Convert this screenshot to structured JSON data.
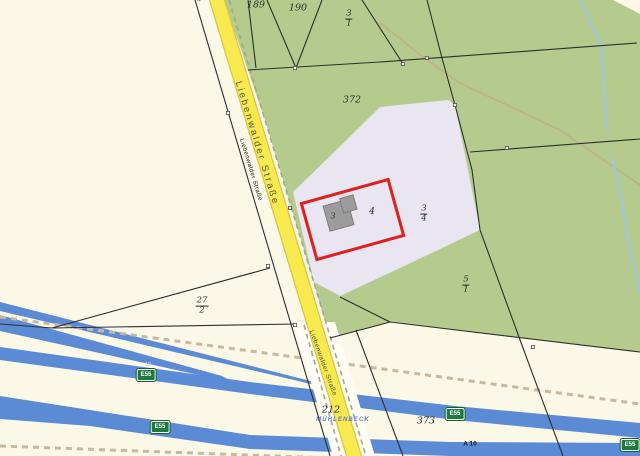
{
  "map": {
    "road_name_labels": [
      {
        "text": "Liebenwalder Straße"
      },
      {
        "text": "Liebenwalder Straße"
      },
      {
        "text": "Liebenwalder Straße"
      },
      {
        "text": "Liebenwalder Straße"
      }
    ],
    "parcel_labels": [
      {
        "text": "189"
      },
      {
        "text": "190"
      },
      {
        "text": "372"
      },
      {
        "text": "4"
      },
      {
        "text": "3"
      },
      {
        "text": "212"
      },
      {
        "text": "373"
      }
    ],
    "fraction_labels": [
      {
        "num": "3",
        "den": "1"
      },
      {
        "num": "3",
        "den": "4"
      },
      {
        "num": "5",
        "den": "1"
      },
      {
        "num": "27",
        "den": "2"
      }
    ],
    "route_badges": [
      {
        "text": "E55"
      },
      {
        "text": "E55"
      },
      {
        "text": "E55"
      },
      {
        "text": "E55"
      }
    ],
    "place_label": "MÜHLENBECK",
    "motorway_label": "A 10",
    "motorway_small_label": "10",
    "colors": {
      "background_cream": "#fbf8e8",
      "forest_green": "#b5cb8e",
      "parcel_lavender": "#e9e5f1",
      "road_yellow": "#f7e94e",
      "road_casing": "#d8c544",
      "motorway_blue": "#5b8bd5",
      "highlight_red": "#e0201c",
      "building_gray": "#9c9c9c",
      "badge_green": "#1e7a3e",
      "place_name_blue": "#5f79c8",
      "stream_blue": "#a3c6dc",
      "boundary_dash_beige": "#c8b89e"
    }
  }
}
